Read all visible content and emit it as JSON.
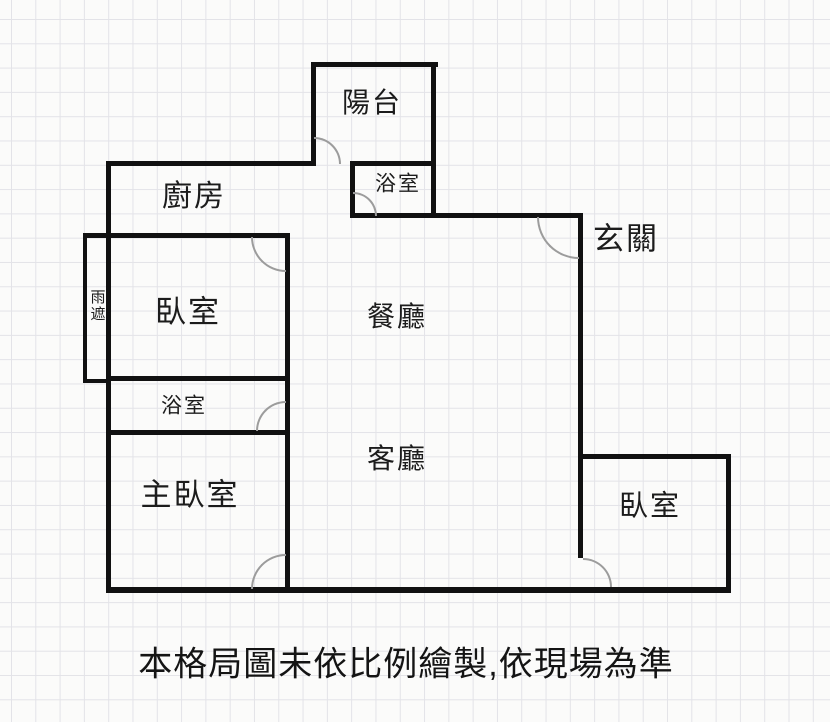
{
  "meta": {
    "type": "floor-plan",
    "caption": "本格局圖未依比例繪製,依現場為準"
  },
  "colors": {
    "background": "#fbfbfa",
    "grid_line": "#e3e3e8",
    "wall": "#111111",
    "door_arc": "#9c9c9c",
    "text": "#1c1c1c"
  },
  "rooms": [
    {
      "id": "balcony",
      "label": "陽台"
    },
    {
      "id": "bathroom-top",
      "label": "浴室"
    },
    {
      "id": "kitchen",
      "label": "廚房"
    },
    {
      "id": "entryway",
      "label": "玄關"
    },
    {
      "id": "bedroom-left",
      "label": "臥室"
    },
    {
      "id": "rain-cover",
      "label": "雨遮"
    },
    {
      "id": "dining-room",
      "label": "餐廳"
    },
    {
      "id": "bathroom-mid",
      "label": "浴室"
    },
    {
      "id": "living-room",
      "label": "客廳"
    },
    {
      "id": "master-bedroom",
      "label": "主臥室"
    },
    {
      "id": "bedroom-right",
      "label": "臥室"
    }
  ]
}
